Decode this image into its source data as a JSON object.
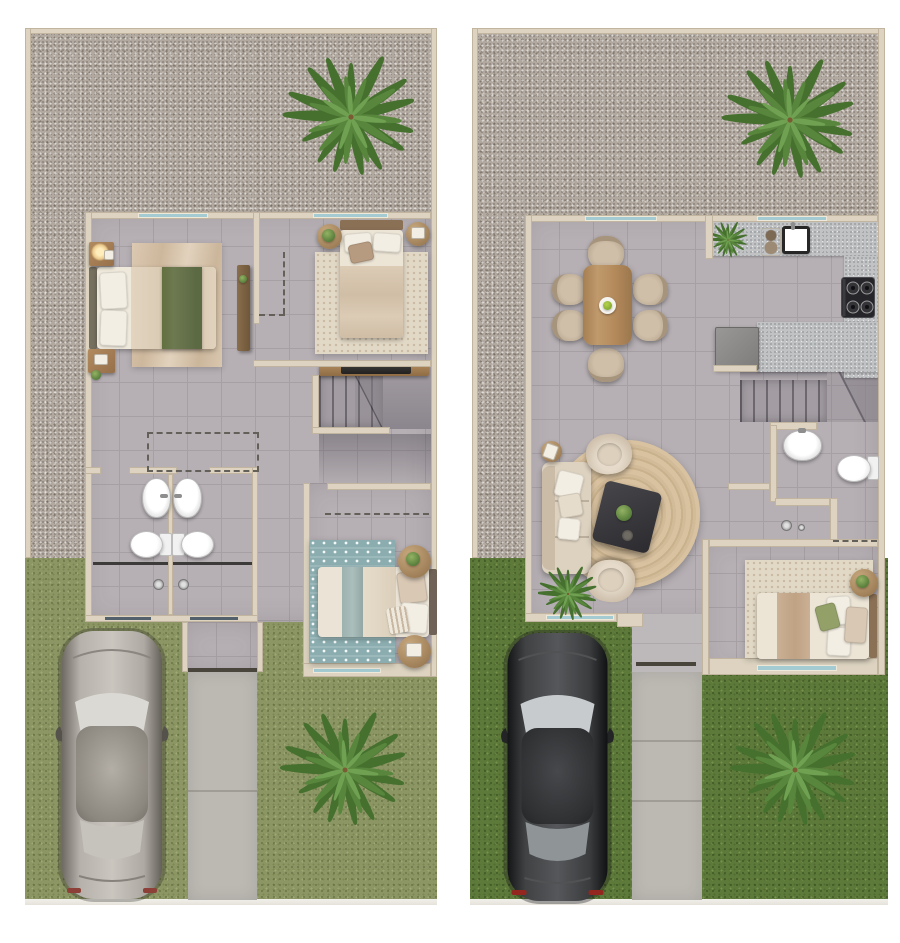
{
  "document": {
    "type": "architectural floor-plan rendering",
    "description": "Top-down 3D rendered floor plans of a two-storey house shown side by side: upper floor on the left, ground floor on the right. No text labels are rendered in the image.",
    "visible_text": "none",
    "panel_count": 2
  },
  "panels": [
    {
      "id": "upper-floor",
      "side": "left",
      "outdoor_elements": [
        "gravel yard with palm tree",
        "olive-green lawn",
        "silver car parked on lawn",
        "concrete walkway",
        "second palm tree on lawn"
      ],
      "rooms": [
        {
          "name": "bedroom-1",
          "furniture": [
            "double bed with green throw",
            "two white pillows",
            "nightstand with lamp",
            "nightstand with plant",
            "area rug",
            "tall wardrobe",
            "window"
          ]
        },
        {
          "name": "bedroom-2",
          "furniture": [
            "double bed",
            "round side table with plant",
            "round side table with decor",
            "textured area rug",
            "dashed closet outline",
            "window"
          ]
        },
        {
          "name": "bathroom-left",
          "furniture": [
            "vessel sink",
            "toilet",
            "shower with glass screen",
            "window"
          ]
        },
        {
          "name": "bathroom-right",
          "furniture": [
            "vessel sink",
            "toilet",
            "shower with glass screen",
            "window"
          ]
        },
        {
          "name": "stair-hall",
          "furniture": [
            "staircase with winder",
            "console table with dark tray",
            "dashed closet outline"
          ]
        },
        {
          "name": "bedroom-3",
          "furniture": [
            "double bed",
            "teal patterned rug",
            "round side table with plant",
            "round side table with decor",
            "dashed line",
            "window"
          ]
        }
      ]
    },
    {
      "id": "ground-floor",
      "side": "right",
      "outdoor_elements": [
        "gravel yard with palm tree",
        "dark green lawn",
        "black car parked on lawn",
        "concrete walkway",
        "second palm tree on lawn"
      ],
      "rooms": [
        {
          "name": "dining-room",
          "furniture": [
            "wooden dining table",
            "six upholstered chairs",
            "white centerpiece plate with greens",
            "window"
          ]
        },
        {
          "name": "kitchen",
          "furniture": [
            "speckled counter with sink",
            "coffee set",
            "counter plant",
            "gas stove with four burners",
            "refrigerator",
            "peninsula counter",
            "window"
          ]
        },
        {
          "name": "stairwell",
          "furniture": [
            "staircase with winder"
          ]
        },
        {
          "name": "bathroom",
          "furniture": [
            "round sink",
            "toilet",
            "shower head",
            "dashed under-stair closet"
          ]
        },
        {
          "name": "living-room",
          "furniture": [
            "beige sofa with pillows",
            "two tub armchairs",
            "round jute rug",
            "dark coffee table with plant and tray",
            "round side table with book",
            "floor plant",
            "window"
          ]
        },
        {
          "name": "bedroom-ground",
          "furniture": [
            "double bed with green pillow",
            "textured rug",
            "round side table with plant",
            "window"
          ]
        }
      ]
    }
  ],
  "colors": {
    "wall_fill": "#ddd3c0",
    "wall_edge": "#c2b5a0",
    "floor_tile": "#b6b0b4",
    "floor_grout": "#a6a0a4",
    "gravel_base": "#b1a89f",
    "grass_left": "#8c9665",
    "grass_right": "#5e7a3a",
    "path_gray": "#bcb9b3",
    "window_glass": "#a4cad2",
    "window_dark": "#51606a",
    "counter_speckle": "#c0c2c4",
    "stair_tread": "#a39da3",
    "rug_teal": "#8badaf",
    "rug_nub": "#e2d8c6",
    "throw_green": "#6d7950",
    "pillow_green": "#93a169",
    "door_dark": "#49443c",
    "palm_dark": "#45702e",
    "palm_mid": "#58863c",
    "palm_light": "#70a152",
    "car_silver": "#b0aca5",
    "car_black": "#2b2d2f"
  }
}
